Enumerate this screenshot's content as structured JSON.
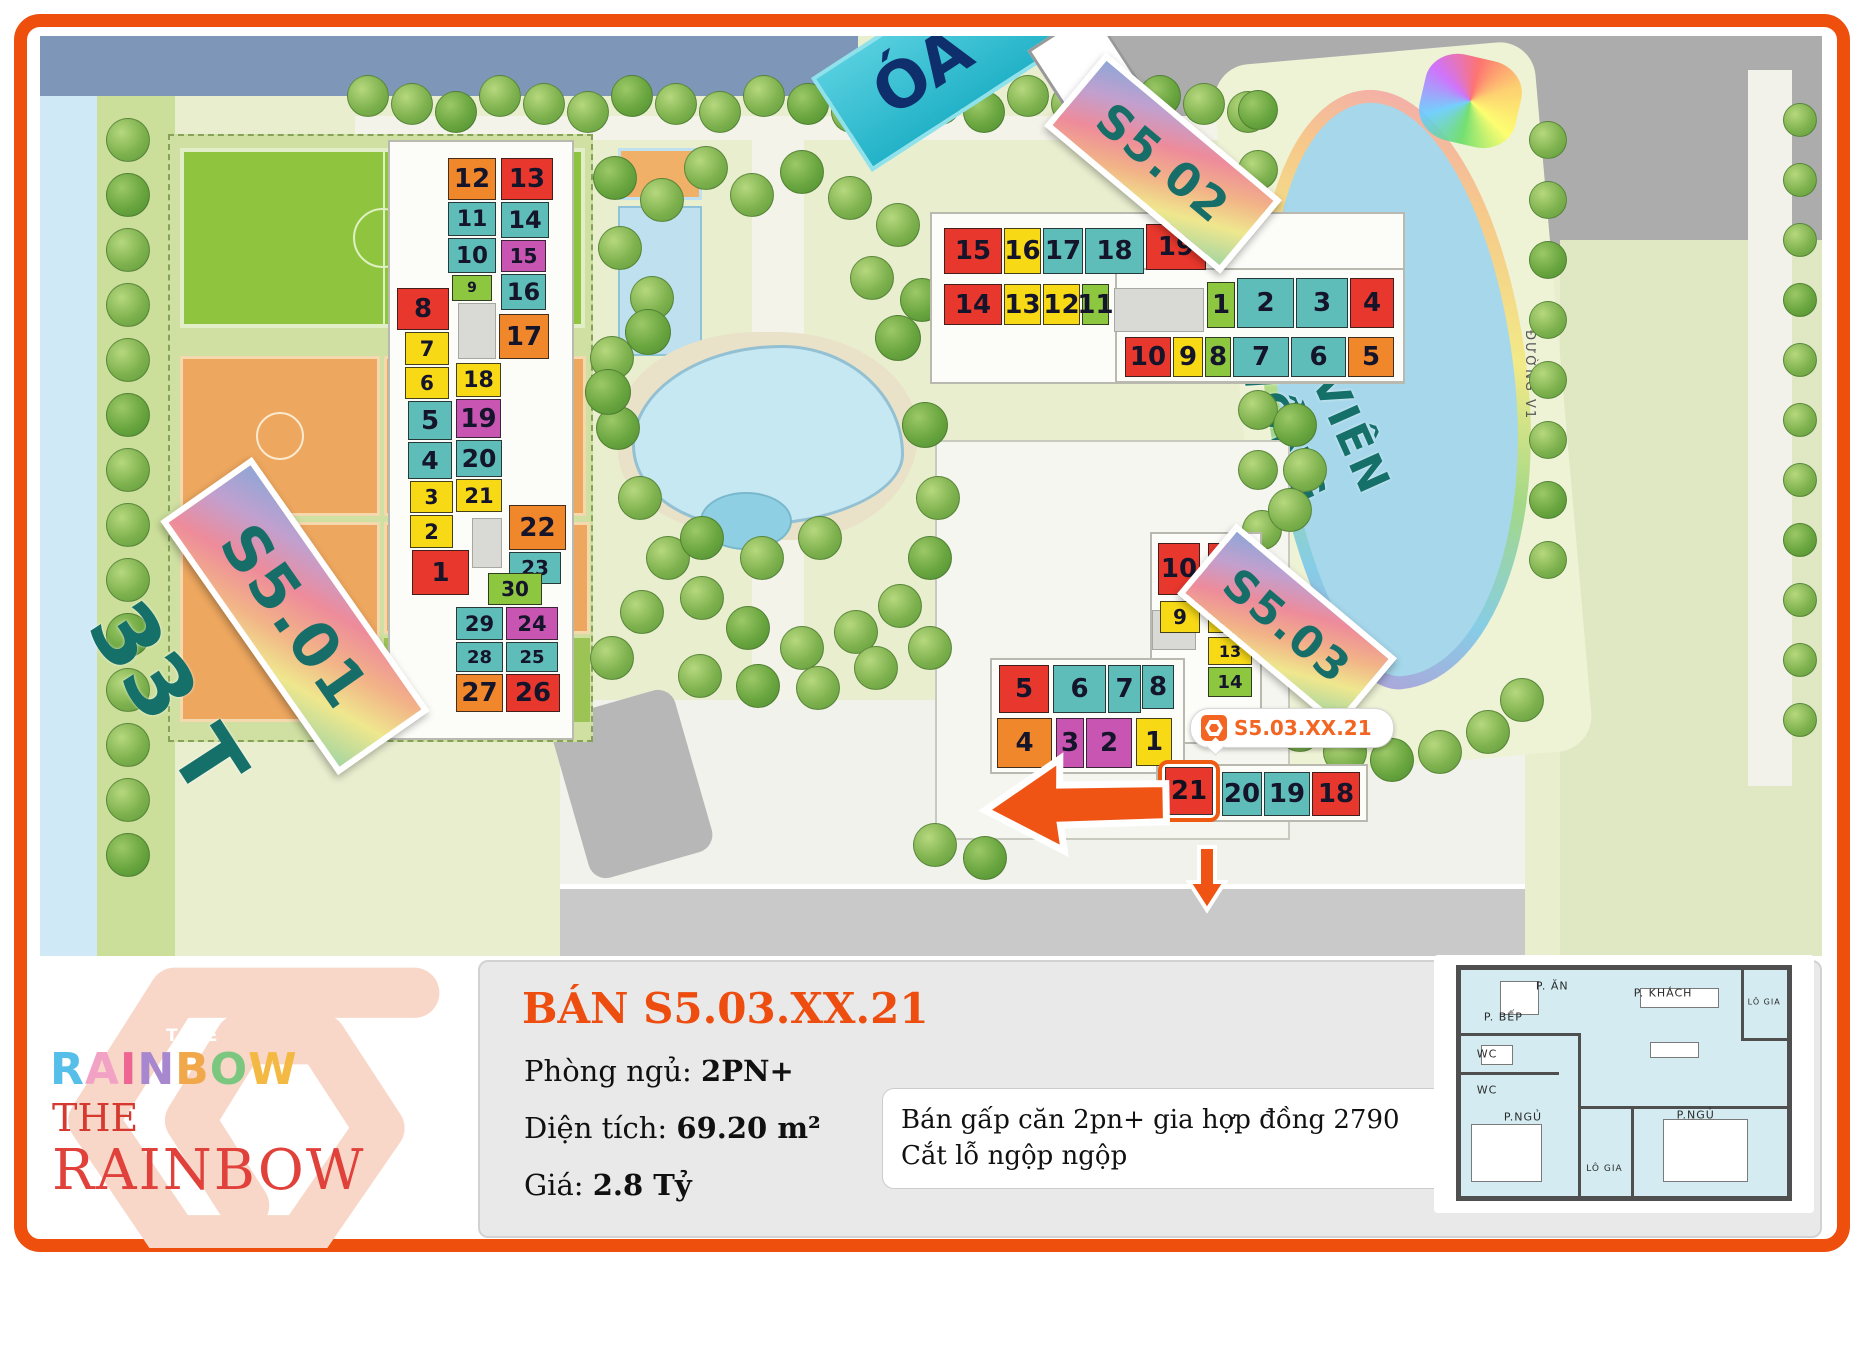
{
  "map": {
    "palette": {
      "red": "#e8372c",
      "orange": "#f0872a",
      "yellow": "#f7d916",
      "teal": "#5fbdb9",
      "green": "#8dc63f",
      "magenta": "#c855b2"
    },
    "labels": {
      "s501": "S5.01",
      "s502": "S5.02",
      "s503": "S5.03",
      "tower_floors": "33 T",
      "park_line1": "CÔNG VIÊN",
      "park_line2": "CẦU VỒNG",
      "top_partial": "ÓA",
      "road": "ĐƯỜNG V1"
    },
    "marker": {
      "text": "S5.03.XX.21"
    },
    "highlight": {
      "label": "21"
    },
    "units": [
      {
        "b": "s501",
        "n": "12",
        "x": 408,
        "y": 122,
        "w": 48,
        "h": 42,
        "c": "orange"
      },
      {
        "b": "s501",
        "n": "11",
        "x": 408,
        "y": 166,
        "w": 48,
        "h": 34,
        "c": "teal"
      },
      {
        "b": "s501",
        "n": "10",
        "x": 408,
        "y": 202,
        "w": 48,
        "h": 35,
        "c": "teal"
      },
      {
        "b": "s501",
        "n": "9",
        "x": 412,
        "y": 239,
        "w": 40,
        "h": 26,
        "c": "green"
      },
      {
        "b": "s501",
        "n": "8",
        "x": 357,
        "y": 252,
        "w": 52,
        "h": 42,
        "c": "red"
      },
      {
        "b": "s501",
        "n": "7",
        "x": 365,
        "y": 296,
        "w": 44,
        "h": 33,
        "c": "yellow"
      },
      {
        "b": "s501",
        "n": "6",
        "x": 365,
        "y": 331,
        "w": 44,
        "h": 32,
        "c": "yellow"
      },
      {
        "b": "s501",
        "n": "5",
        "x": 368,
        "y": 365,
        "w": 44,
        "h": 39,
        "c": "teal"
      },
      {
        "b": "s501",
        "n": "4",
        "x": 368,
        "y": 406,
        "w": 44,
        "h": 37,
        "c": "teal"
      },
      {
        "b": "s501",
        "n": "3",
        "x": 370,
        "y": 445,
        "w": 43,
        "h": 32,
        "c": "yellow"
      },
      {
        "b": "s501",
        "n": "2",
        "x": 370,
        "y": 479,
        "w": 43,
        "h": 33,
        "c": "yellow"
      },
      {
        "b": "s501",
        "n": "1",
        "x": 372,
        "y": 514,
        "w": 57,
        "h": 45,
        "c": "red"
      },
      {
        "b": "s501",
        "n": "13",
        "x": 461,
        "y": 122,
        "w": 52,
        "h": 42,
        "c": "red"
      },
      {
        "b": "s501",
        "n": "14",
        "x": 461,
        "y": 166,
        "w": 48,
        "h": 36,
        "c": "teal"
      },
      {
        "b": "s501",
        "n": "15",
        "x": 461,
        "y": 204,
        "w": 45,
        "h": 32,
        "c": "magenta"
      },
      {
        "b": "s501",
        "n": "16",
        "x": 461,
        "y": 238,
        "w": 45,
        "h": 36,
        "c": "teal"
      },
      {
        "b": "s501",
        "n": "17",
        "x": 459,
        "y": 278,
        "w": 50,
        "h": 45,
        "c": "orange"
      },
      {
        "b": "s501",
        "n": "18",
        "x": 416,
        "y": 327,
        "w": 45,
        "h": 34,
        "c": "yellow"
      },
      {
        "b": "s501",
        "n": "19",
        "x": 416,
        "y": 363,
        "w": 45,
        "h": 39,
        "c": "magenta"
      },
      {
        "b": "s501",
        "n": "20",
        "x": 416,
        "y": 404,
        "w": 46,
        "h": 37,
        "c": "teal"
      },
      {
        "b": "s501",
        "n": "21",
        "x": 416,
        "y": 443,
        "w": 46,
        "h": 33,
        "c": "yellow"
      },
      {
        "b": "s501",
        "n": "22",
        "x": 469,
        "y": 469,
        "w": 57,
        "h": 45,
        "c": "orange"
      },
      {
        "b": "s501",
        "n": "23",
        "x": 469,
        "y": 516,
        "w": 52,
        "h": 32,
        "c": "teal"
      },
      {
        "b": "s501",
        "n": "30",
        "x": 448,
        "y": 537,
        "w": 54,
        "h": 32,
        "c": "green"
      },
      {
        "b": "s501",
        "n": "29",
        "x": 416,
        "y": 571,
        "w": 47,
        "h": 33,
        "c": "teal"
      },
      {
        "b": "s501",
        "n": "24",
        "x": 466,
        "y": 571,
        "w": 52,
        "h": 33,
        "c": "magenta"
      },
      {
        "b": "s501",
        "n": "28",
        "x": 416,
        "y": 606,
        "w": 47,
        "h": 30,
        "c": "teal"
      },
      {
        "b": "s501",
        "n": "25",
        "x": 466,
        "y": 606,
        "w": 52,
        "h": 30,
        "c": "teal"
      },
      {
        "b": "s501",
        "n": "27",
        "x": 416,
        "y": 638,
        "w": 47,
        "h": 38,
        "c": "orange"
      },
      {
        "b": "s501",
        "n": "26",
        "x": 466,
        "y": 638,
        "w": 54,
        "h": 38,
        "c": "red"
      },
      {
        "b": "s502",
        "n": "15",
        "x": 904,
        "y": 192,
        "w": 58,
        "h": 46,
        "c": "red"
      },
      {
        "b": "s502",
        "n": "16",
        "x": 964,
        "y": 192,
        "w": 37,
        "h": 46,
        "c": "yellow"
      },
      {
        "b": "s502",
        "n": "17",
        "x": 1003,
        "y": 192,
        "w": 40,
        "h": 46,
        "c": "teal"
      },
      {
        "b": "s502",
        "n": "18",
        "x": 1045,
        "y": 192,
        "w": 59,
        "h": 46,
        "c": "teal"
      },
      {
        "b": "s502",
        "n": "19",
        "x": 1106,
        "y": 188,
        "w": 60,
        "h": 46,
        "c": "red"
      },
      {
        "b": "s502",
        "n": "14",
        "x": 904,
        "y": 248,
        "w": 58,
        "h": 41,
        "c": "red"
      },
      {
        "b": "s502",
        "n": "13",
        "x": 964,
        "y": 248,
        "w": 37,
        "h": 41,
        "c": "yellow"
      },
      {
        "b": "s502",
        "n": "12",
        "x": 1003,
        "y": 248,
        "w": 37,
        "h": 41,
        "c": "yellow"
      },
      {
        "b": "s502",
        "n": "11",
        "x": 1042,
        "y": 248,
        "w": 27,
        "h": 41,
        "c": "green"
      },
      {
        "b": "s502",
        "n": "1",
        "x": 1167,
        "y": 246,
        "w": 28,
        "h": 46,
        "c": "green"
      },
      {
        "b": "s502",
        "n": "2",
        "x": 1197,
        "y": 242,
        "w": 57,
        "h": 50,
        "c": "teal"
      },
      {
        "b": "s502",
        "n": "3",
        "x": 1256,
        "y": 242,
        "w": 52,
        "h": 50,
        "c": "teal"
      },
      {
        "b": "s502",
        "n": "4",
        "x": 1310,
        "y": 242,
        "w": 44,
        "h": 50,
        "c": "red"
      },
      {
        "b": "s502",
        "n": "10",
        "x": 1085,
        "y": 301,
        "w": 46,
        "h": 40,
        "c": "red"
      },
      {
        "b": "s502",
        "n": "9",
        "x": 1133,
        "y": 301,
        "w": 30,
        "h": 40,
        "c": "yellow"
      },
      {
        "b": "s502",
        "n": "8",
        "x": 1165,
        "y": 301,
        "w": 26,
        "h": 40,
        "c": "green"
      },
      {
        "b": "s502",
        "n": "7",
        "x": 1193,
        "y": 301,
        "w": 56,
        "h": 40,
        "c": "teal"
      },
      {
        "b": "s502",
        "n": "6",
        "x": 1251,
        "y": 301,
        "w": 55,
        "h": 40,
        "c": "teal"
      },
      {
        "b": "s502",
        "n": "5",
        "x": 1308,
        "y": 301,
        "w": 46,
        "h": 40,
        "c": "orange"
      },
      {
        "b": "s503",
        "n": "10",
        "x": 1118,
        "y": 507,
        "w": 42,
        "h": 52,
        "c": "red"
      },
      {
        "b": "s503",
        "n": "11",
        "x": 1168,
        "y": 507,
        "w": 44,
        "h": 52,
        "c": "red"
      },
      {
        "b": "s503",
        "n": "9",
        "x": 1120,
        "y": 565,
        "w": 40,
        "h": 32,
        "c": "yellow"
      },
      {
        "b": "s503",
        "n": "12",
        "x": 1168,
        "y": 565,
        "w": 44,
        "h": 32,
        "c": "yellow"
      },
      {
        "b": "s503",
        "n": "13",
        "x": 1168,
        "y": 601,
        "w": 44,
        "h": 28,
        "c": "yellow"
      },
      {
        "b": "s503",
        "n": "14",
        "x": 1168,
        "y": 631,
        "w": 44,
        "h": 30,
        "c": "green"
      },
      {
        "b": "s503",
        "n": "5",
        "x": 959,
        "y": 629,
        "w": 50,
        "h": 48,
        "c": "red"
      },
      {
        "b": "s503",
        "n": "6",
        "x": 1013,
        "y": 629,
        "w": 53,
        "h": 48,
        "c": "teal"
      },
      {
        "b": "s503",
        "n": "7",
        "x": 1068,
        "y": 629,
        "w": 33,
        "h": 48,
        "c": "teal"
      },
      {
        "b": "s503",
        "n": "8",
        "x": 1102,
        "y": 629,
        "w": 32,
        "h": 44,
        "c": "teal"
      },
      {
        "b": "s503",
        "n": "4",
        "x": 957,
        "y": 682,
        "w": 55,
        "h": 50,
        "c": "orange"
      },
      {
        "b": "s503",
        "n": "3",
        "x": 1016,
        "y": 682,
        "w": 28,
        "h": 50,
        "c": "magenta"
      },
      {
        "b": "s503",
        "n": "2",
        "x": 1046,
        "y": 682,
        "w": 46,
        "h": 50,
        "c": "magenta"
      },
      {
        "b": "s503",
        "n": "1",
        "x": 1096,
        "y": 682,
        "w": 36,
        "h": 48,
        "c": "yellow"
      },
      {
        "b": "s503",
        "n": "20",
        "x": 1182,
        "y": 736,
        "w": 40,
        "h": 44,
        "c": "teal"
      },
      {
        "b": "s503",
        "n": "19",
        "x": 1224,
        "y": 736,
        "w": 46,
        "h": 44,
        "c": "teal"
      },
      {
        "b": "s503",
        "n": "18",
        "x": 1272,
        "y": 736,
        "w": 48,
        "h": 44,
        "c": "red"
      }
    ]
  },
  "info": {
    "logo": {
      "the_small": "THE",
      "rainbow_letters": [
        {
          "ch": "R",
          "color": "#55bfe9"
        },
        {
          "ch": "A",
          "color": "#f2a3c5"
        },
        {
          "ch": "I",
          "color": "#ee6492"
        },
        {
          "ch": "N",
          "color": "#a788cf"
        },
        {
          "ch": "B",
          "color": "#f0a84b"
        },
        {
          "ch": "O",
          "color": "#7cc77f"
        },
        {
          "ch": "W",
          "color": "#f4b942"
        }
      ],
      "the_red": "THE",
      "rainbow_red": "RAINBOW"
    },
    "title": "BÁN S5.03.XX.21",
    "fields": [
      {
        "label": "Phòng ngủ:",
        "value": "2PN+"
      },
      {
        "label": "Diện tích:",
        "value": "69.20 m²"
      },
      {
        "label": "Giá:",
        "value": "2.8 Tỷ"
      }
    ],
    "note": "Bán gấp căn 2pn+ gia hợp đồng 2790 Cắt lỗ ngộp ngộp",
    "floorplan": {
      "rooms": [
        "P. ĂN",
        "P. KHÁCH",
        "LÔ GIA",
        "P. BẾP",
        "WC",
        "WC",
        "P.NGỦ",
        "LÔ GIA",
        "P.NGỦ"
      ]
    }
  }
}
